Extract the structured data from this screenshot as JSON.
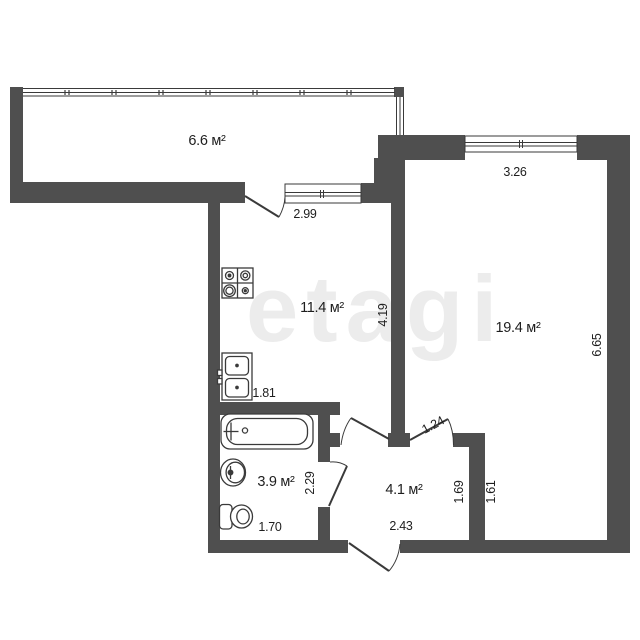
{
  "watermark": "etagi",
  "colors": {
    "wall": "#4f4f4f",
    "line": "#3a3a3a",
    "background": "#ffffff",
    "watermark": "#ececec",
    "text": "#1e1e1e"
  },
  "rooms": {
    "balcony": {
      "area": "6.6 м²"
    },
    "kitchen": {
      "area": "11.4 м²",
      "dims": {
        "width": "2.99",
        "depth": "4.19",
        "bottom": "1.81"
      }
    },
    "living_room": {
      "area": "19.4 м²",
      "dims": {
        "width": "3.26",
        "depth": "6.65",
        "inset": "1.61"
      }
    },
    "bathroom": {
      "area": "3.9 м²",
      "dims": {
        "depth": "2.29",
        "width": "1.70"
      }
    },
    "hallway": {
      "area": "4.1 м²",
      "dims": {
        "door": "1.24",
        "depth": "1.69",
        "width": "2.43"
      }
    }
  },
  "fixtures": [
    "stove-icon",
    "kitchen-sink-icon",
    "bathtub-icon",
    "washbasin-icon",
    "toilet-icon"
  ]
}
